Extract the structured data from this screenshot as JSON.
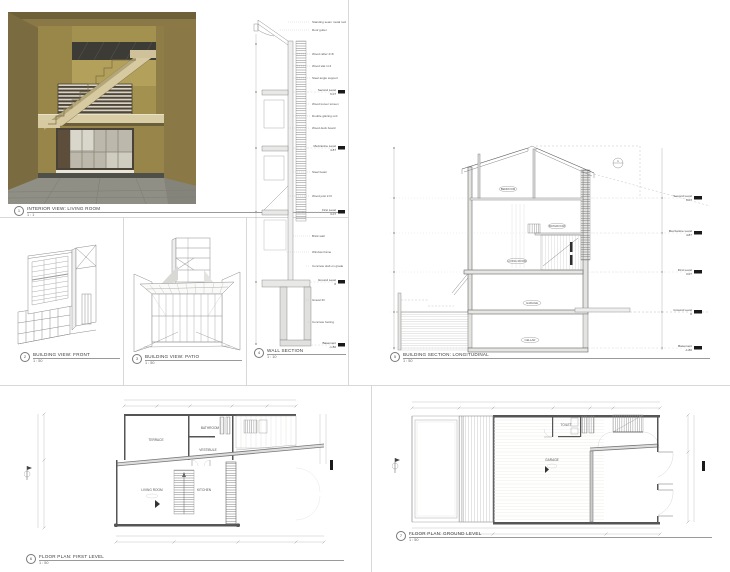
{
  "colors": {
    "render_wall": "#8a7847",
    "marker_black": "#1a1a1a",
    "line_gray": "#8c8c8c"
  },
  "titles": {
    "interior": {
      "num": "1",
      "title": "INTERIOR VIEW: LIVING ROOM",
      "scale": "1 : 1"
    },
    "front": {
      "num": "2",
      "title": "BUILDING VIEW: FRONT",
      "scale": "1 : 50"
    },
    "patio": {
      "num": "3",
      "title": "BUILDING VIEW: PATIO",
      "scale": "1 : 50"
    },
    "wall": {
      "num": "4",
      "title": "WALL SECTION",
      "scale": "1 : 10"
    },
    "section": {
      "num": "5",
      "title": "BUILDING SECTION: LONGITUDINAL",
      "scale": "1 : 50"
    },
    "plan1": {
      "num": "6",
      "title": "FLOOR PLAN: FIRST LEVEL",
      "scale": "1 : 50"
    },
    "plan0": {
      "num": "7",
      "title": "FLOOR PLAN: GROUND LEVEL",
      "scale": "1 : 50"
    }
  },
  "levels": [
    {
      "name": "Second Level",
      "elev": "6.07"
    },
    {
      "name": "Mezzanine Level",
      "elev": "4.87"
    },
    {
      "name": "First Level",
      "elev": "3.07"
    },
    {
      "name": "Ground Level",
      "elev": "0"
    },
    {
      "name": "Basement",
      "elev": "-1.80"
    }
  ],
  "wall_callouts": [
    "Standing seam metal roof",
    "Roof gutter",
    "Wood rafter 2×8",
    "Wood slat 1×4",
    "Steel angle support",
    "Wood louver screen",
    "Double glazing unit",
    "Wood deck board",
    "Steel beam",
    "Wood joist 2×6",
    "Brick wall",
    "Window frame",
    "Concrete slab on grade",
    "Gravel fill",
    "Concrete footing"
  ],
  "section_tags": {
    "attic": "BEDROOM",
    "mezz": "BATHROOM",
    "first": "LIVING ROOM",
    "ground": "GARAGE",
    "basement": "CELLAR",
    "detail": "1"
  },
  "plan1_rooms": {
    "terrace": "TERRACE",
    "bathroom": "BATHROOM",
    "vestibule": "VESTIBULE",
    "living": "LIVING ROOM",
    "kitchen": "KITCHEN"
  },
  "plan0_rooms": {
    "toilet": "TOILET",
    "garage": "GARAGE"
  }
}
